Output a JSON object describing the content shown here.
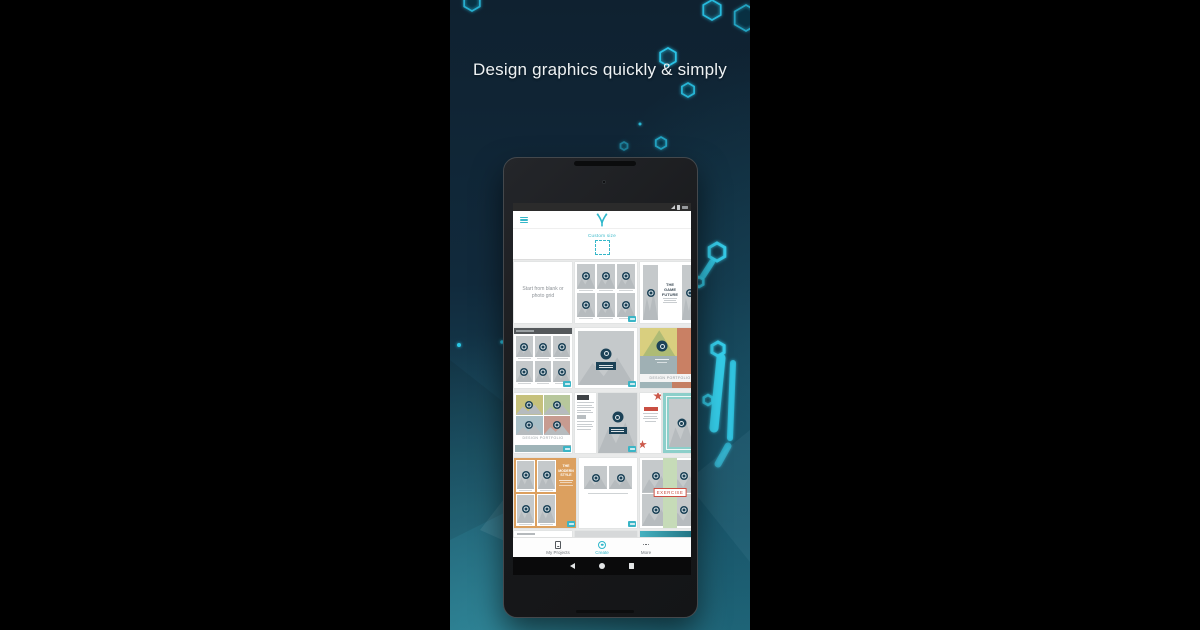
{
  "headline": "Design graphics quickly & simply",
  "colors": {
    "accent_teal": "#35b7c9",
    "hex_cyan": "#29c3e6",
    "background_top": "#0f2130",
    "background_bottom": "#1e6376",
    "grid_background": "#e9eaea",
    "placeholder_gray": "#c5c9cb",
    "placeholder_circle_navy": "#1c4257"
  },
  "icons": {
    "menu": "hamburger-menu-icon",
    "logo": "desygner-logo",
    "status": [
      "wifi-icon",
      "battery-icon",
      "clock-icon"
    ],
    "nav": [
      "projects-device-icon",
      "create-circle-icon",
      "ellipsis-icon"
    ],
    "android": [
      "back-icon",
      "home-icon",
      "recents-icon"
    ]
  },
  "tablet": {
    "format_picker": {
      "label": "Custom size"
    },
    "templates": {
      "start_blank_label": "Start from blank or photo grid",
      "game_future_title": "THE GAME FUTURE",
      "portfolio_color_caption": "DESIGN PORTFOLIO",
      "portfolio_grid_caption": "DESIGN PORTFOLIO",
      "modern_style_title": "THE MODERN STYLE",
      "exercise_label": "EXERCISE"
    },
    "bottom_nav": {
      "items": [
        {
          "label": "My Projects",
          "active": false
        },
        {
          "label": "Create",
          "active": true
        },
        {
          "label": "More",
          "active": false
        }
      ]
    }
  }
}
